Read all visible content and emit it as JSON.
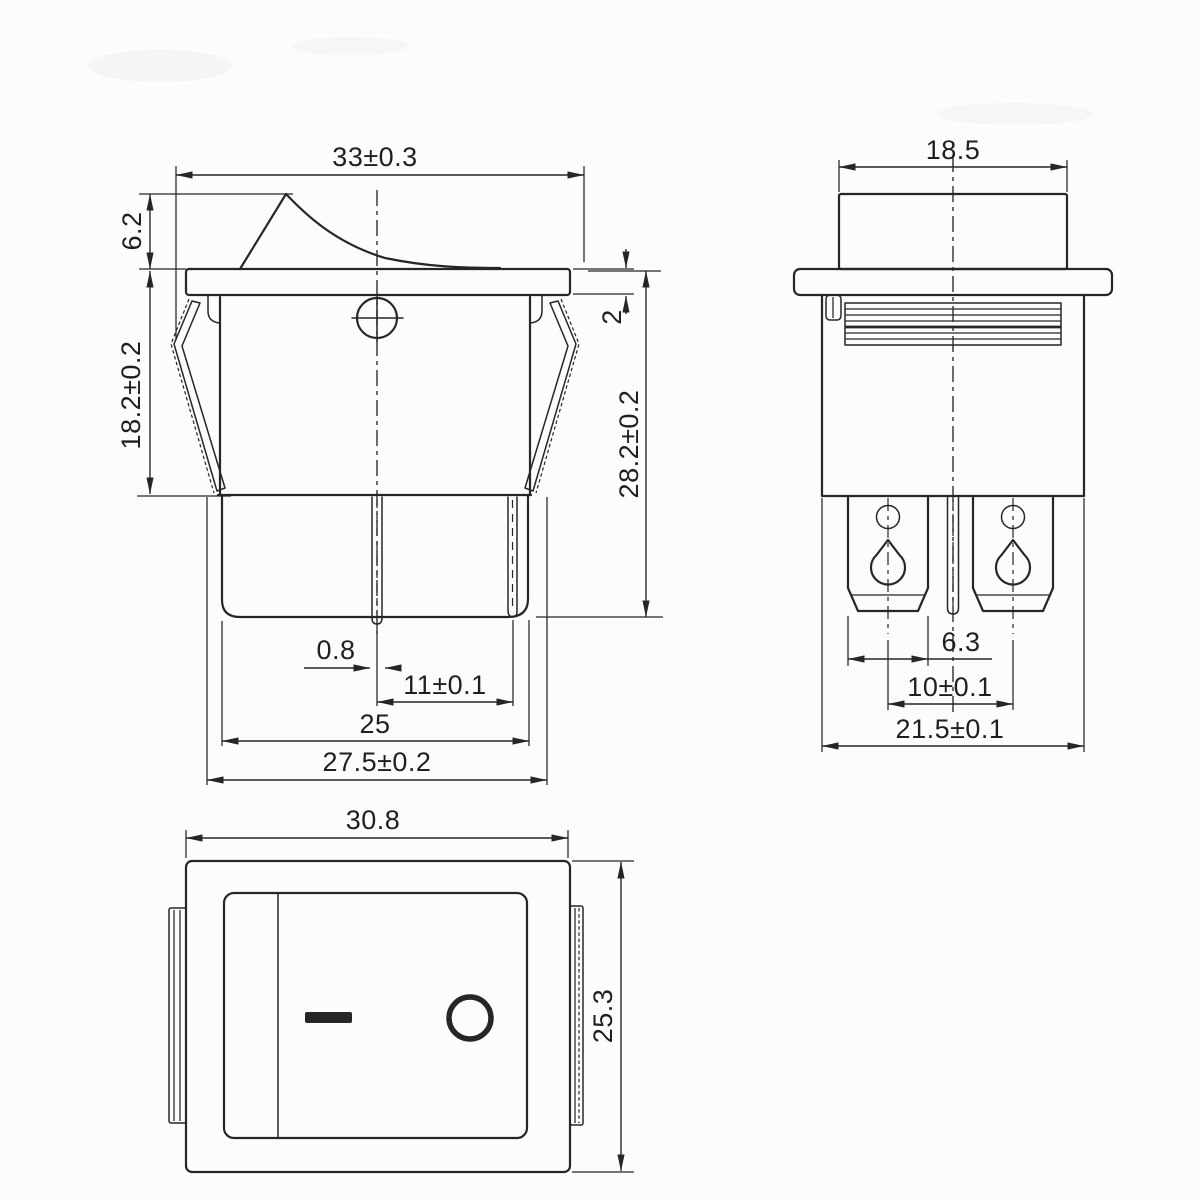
{
  "document": {
    "type": "technical dimension drawing",
    "subject": "rocker switch, 3 views"
  },
  "colors": {
    "background": "#fcfcfc",
    "line": "#262626",
    "text": "#1f1f1f"
  },
  "dims": {
    "front": {
      "width_top": "33±0.3",
      "rocker_height": "6.2",
      "body_height": "18.2±0.2",
      "flange_thickness": "2",
      "overall_height": "28.2±0.2",
      "pin_thickness": "0.8",
      "pin_pitch": "11±0.1",
      "body_bottom_width": "25",
      "mount_width": "27.5±0.2"
    },
    "side": {
      "rocker_width": "18.5",
      "terminal_width": "6.3",
      "terminal_pitch": "10±0.1",
      "body_width": "21.5±0.1"
    },
    "face": {
      "width": "30.8",
      "height": "25.3"
    }
  },
  "rocker_markings": {
    "on": "I",
    "off": "O"
  }
}
